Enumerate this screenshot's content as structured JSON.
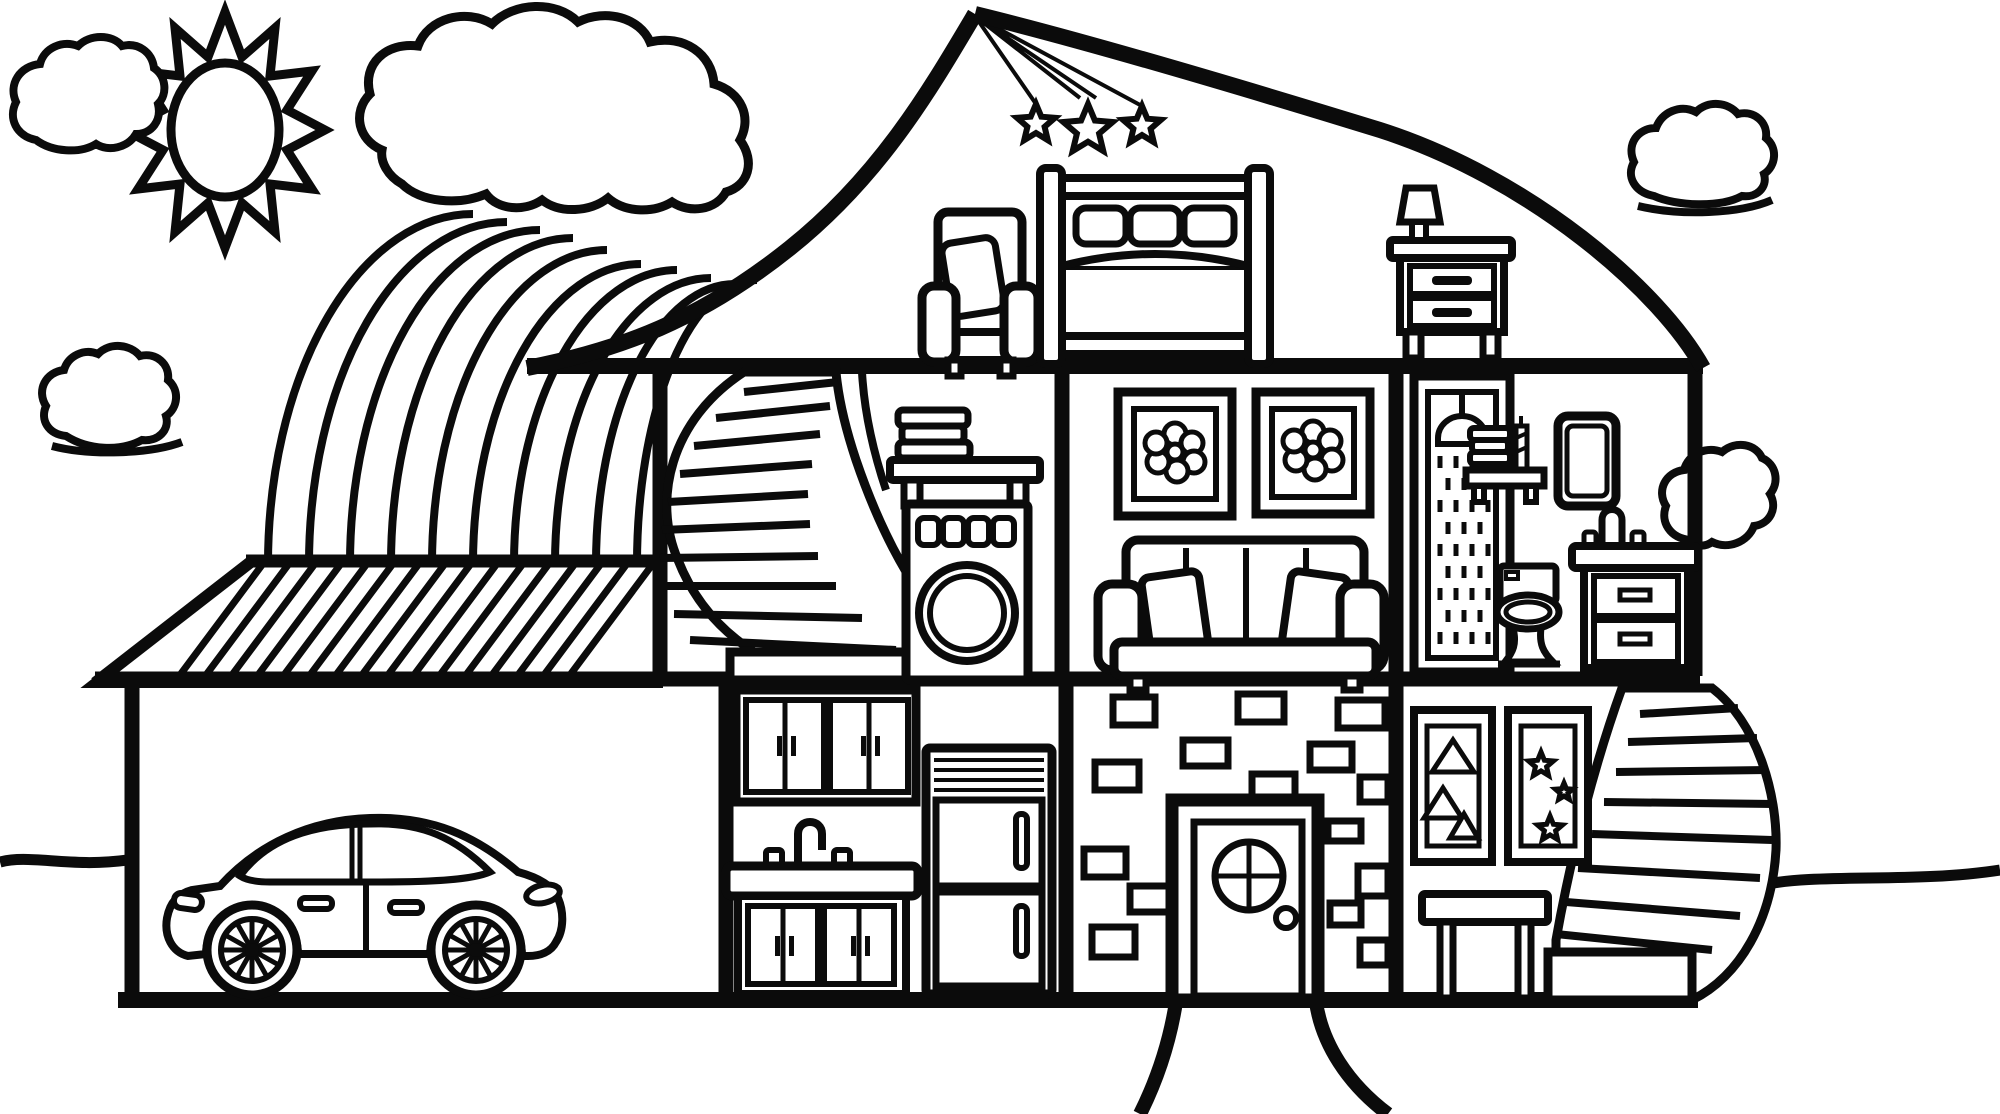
{
  "meta": {
    "artwork": "Dollhouse cross-section coloring page",
    "style": "black outline coloring-book line art, no text",
    "background_color": "#ffffff",
    "line_color": "#0b0b0b"
  },
  "sky": {
    "sun": "Sun with zigzag rays",
    "cloud_top_left": "Small cloud (top left)",
    "cloud_mid_left": "Small cloud (mid left)",
    "cloud_big": "Large cloud feeding the rainbow",
    "cloud_right": "Cloud (upper right)",
    "cloud_lower_right": "Small cloud (right of house)",
    "rainbow": "Rainbow of 10 bands landing on garage roof"
  },
  "house": {
    "roof": "Gable roof with peak",
    "attic": {
      "label": "Attic bedroom",
      "stars": "Three stars hanging on strings from roof peak",
      "armchair": "Armchair with tilted cushion",
      "bed": "Double bed with headboard, three pillows and footboard",
      "drape": "Blanket draped over bed corner",
      "nightstand": "Nightstand with two drawers",
      "lamp": "Table lamp on nightstand"
    },
    "second_floor": {
      "laundry": {
        "label": "Landing / laundry room",
        "stairs": "Curved spiral staircase",
        "shelf": "Wall shelf with stacked towels",
        "washer": "Washing machine with four dials and round door"
      },
      "living": {
        "label": "Living room",
        "picture_left": "Framed flower picture",
        "picture_right": "Framed flower picture",
        "sofa": "Sofa with four back cushions and two pillows"
      },
      "bathroom": {
        "label": "Bathroom",
        "shower": "Shower stall with shower head and water",
        "shelf": "Shelf with towels and striped candle",
        "mirror": "Wall mirror",
        "toilet": "Toilet",
        "vanity": "Sink vanity with faucet and two drawers"
      }
    },
    "ground_floor": {
      "garage": {
        "label": "Garage with hatched roof",
        "car": "Sedan car with spoked wheels"
      },
      "kitchen": {
        "label": "Kitchen",
        "upper_cabinets": "Upper cabinets, four doors",
        "sink": "Sink counter with faucet",
        "lower_cabinets": "Lower cabinets, four doors",
        "fridge": "Refrigerator with two doors"
      },
      "entry": {
        "label": "Entry hall with brick wall",
        "door": "Front door with round cross window and doorknob"
      },
      "family_room": {
        "label": "Play room",
        "picture_triangles": "Framed picture with triangles",
        "picture_stars": "Framed picture with stars",
        "table": "Small table",
        "stairs": "Curved exterior staircase"
      }
    }
  },
  "ground": {
    "left_line": "Ground line (left)",
    "right_line": "Ground line (right)",
    "path": "Curved path from front door"
  }
}
